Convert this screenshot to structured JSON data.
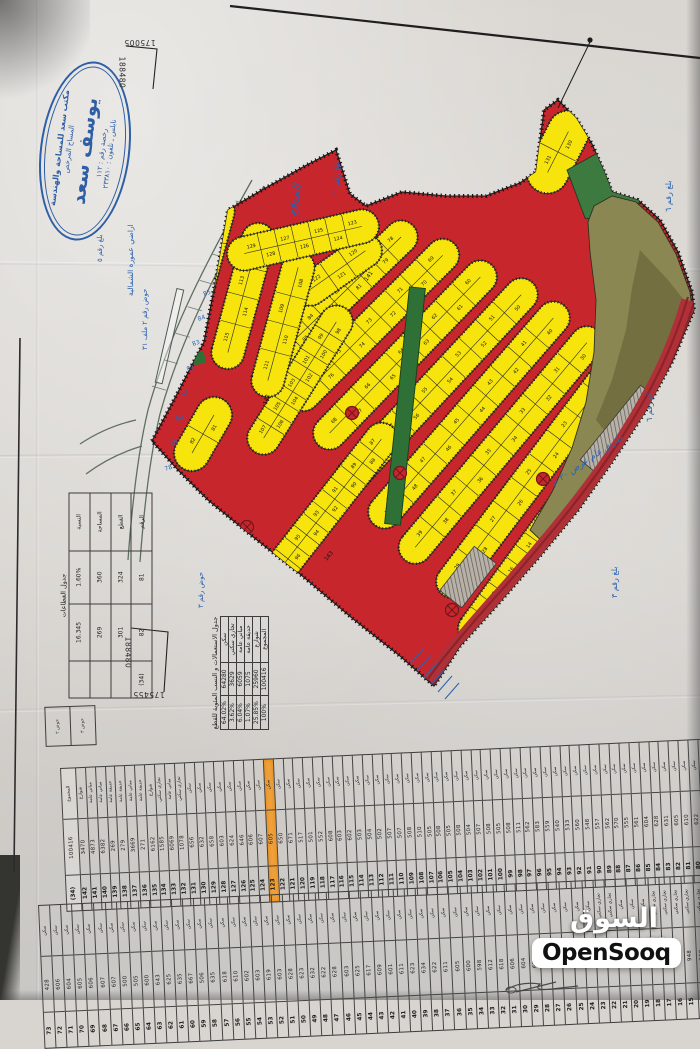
{
  "watermark": {
    "arabic": "السوق المفتوح",
    "latin": "OpenSooq"
  },
  "stamp": {
    "office": "مكتب سعد للمساحة والهندسة",
    "role": "المساح المرخص",
    "name": "يوسف سعد",
    "license": "رخصة رقم : ١١٢",
    "city_phone": "نابلس ـ تلفون : ٢٣٣٨١٠"
  },
  "grid_coords": {
    "top_x": "175005",
    "top_y": "188480",
    "bottom_x": "175455",
    "bottom_y": "188480"
  },
  "annotations": {
    "site_label": "الموقع",
    "area_line1": "اراضي عمورة الشمالية",
    "area_line2": "حوض رقم ٢ ملف ٣١",
    "basin_label": "حوض رقم ٣",
    "block2": "بلغ رقم ٢",
    "block3": "بلغ رقم ٣",
    "block5": "بلغ رقم ٥",
    "block6a": "بلغ رقم ٦",
    "block6b": "بلغ رقم ٦",
    "road_note": "طريق عام عرض ٢٠ م",
    "street_numbers": [
      "141",
      "142",
      "143"
    ],
    "edge_numbers": [
      "85",
      "84",
      "83",
      "82",
      "81",
      "80",
      "79",
      "78"
    ]
  },
  "use_table": {
    "title": "جدول الاستعمالات و النسب المئوية للقطع",
    "headers": [
      "الاستعمال",
      "المساحة م٢",
      "النسبة المئوية"
    ],
    "rows": [
      [
        "سكن",
        "64280",
        "64.02%"
      ],
      [
        "تجاري سكني",
        "3629",
        "3.62%"
      ],
      [
        "مباني عامة",
        "6059",
        "6.04%"
      ],
      [
        "حديقة عامة",
        "1075",
        "1.07%"
      ],
      [
        "شوارع",
        "25960",
        "25.85%"
      ],
      [
        "المجموع",
        "100416",
        "100%"
      ]
    ]
  },
  "sector_table": {
    "title": "جدول القطاعات",
    "rows": [
      [
        "النسبة",
        "1.60%",
        "16.345",
        ""
      ],
      [
        "المساحة",
        "360",
        "269",
        ""
      ],
      [
        "القطع",
        "324",
        "301",
        ""
      ],
      [
        "الرقم",
        "81",
        "82",
        "(34)"
      ]
    ]
  },
  "parcel_table": {
    "headers": {
      "use": "الاستعمال",
      "area": "المساحة م٢",
      "no": "رقم القطعة"
    },
    "highlight_no": "123",
    "default_use": "سكن",
    "strip1": [
      [
        "(34)",
        "100416",
        "المجموع"
      ],
      [
        "142",
        "3470",
        "شوارع"
      ],
      [
        "141",
        "4873",
        "مباني عامة"
      ],
      [
        "140",
        "6382",
        "مباني عامة"
      ],
      [
        "139",
        "269",
        "حديقة عامة"
      ],
      [
        "138",
        "279",
        "حديقة عامة"
      ],
      [
        "137",
        "3669",
        "مباني عامة"
      ],
      [
        "136",
        "271",
        "حديقة عامة"
      ],
      [
        "135",
        "6162",
        "شوارع"
      ],
      [
        "134",
        "1585",
        "تجاري سكني"
      ],
      [
        "133",
        "6069",
        "مباني عامة"
      ],
      [
        "132",
        "1078",
        "تجاري سكني"
      ],
      [
        "131",
        "656"
      ],
      [
        "130",
        "632"
      ],
      [
        "129",
        "658"
      ],
      [
        "128",
        "603"
      ],
      [
        "127",
        "624"
      ],
      [
        "126",
        "646"
      ],
      [
        "125",
        "606"
      ],
      [
        "124",
        "607"
      ],
      [
        "123",
        "605"
      ],
      [
        "122",
        "650"
      ],
      [
        "121",
        "671"
      ],
      [
        "120",
        "517"
      ],
      [
        "119",
        "501"
      ],
      [
        "118",
        "552"
      ],
      [
        "117",
        "608"
      ],
      [
        "116",
        "603"
      ],
      [
        "115",
        "602"
      ],
      [
        "114",
        "503"
      ],
      [
        "113",
        "504"
      ],
      [
        "112",
        "502"
      ],
      [
        "111",
        "507"
      ],
      [
        "110",
        "507"
      ],
      [
        "109",
        "508"
      ],
      [
        "108",
        "510"
      ],
      [
        "107",
        "505"
      ],
      [
        "106",
        "508"
      ],
      [
        "105",
        "505"
      ],
      [
        "104",
        "508"
      ],
      [
        "103",
        "504"
      ],
      [
        "102",
        "507"
      ],
      [
        "101",
        "508"
      ],
      [
        "100",
        "505"
      ],
      [
        "99",
        "508"
      ],
      [
        "98",
        "511"
      ],
      [
        "97",
        "562"
      ],
      [
        "96",
        "583"
      ],
      [
        "95",
        "559"
      ],
      [
        "94",
        "540"
      ],
      [
        "93",
        "533"
      ],
      [
        "92",
        "560"
      ],
      [
        "91",
        "548"
      ],
      [
        "90",
        "557"
      ],
      [
        "89",
        "562"
      ],
      [
        "88",
        "570"
      ],
      [
        "87",
        "555"
      ],
      [
        "86",
        "561"
      ],
      [
        "85",
        "604"
      ],
      [
        "84",
        "628"
      ],
      [
        "83",
        "631"
      ],
      [
        "82",
        "605"
      ],
      [
        "81",
        "610"
      ],
      [
        "80",
        "622"
      ],
      [
        "79",
        "618"
      ],
      [
        "78",
        "607"
      ],
      [
        "77",
        "606"
      ],
      [
        "76",
        "605"
      ],
      [
        "75",
        "604"
      ],
      [
        "74",
        "603"
      ]
    ],
    "strip2": [
      [
        "73",
        "428"
      ],
      [
        "72",
        "606"
      ],
      [
        "71",
        "604"
      ],
      [
        "70",
        "605"
      ],
      [
        "69",
        "606"
      ],
      [
        "68",
        "607"
      ],
      [
        "67",
        "607"
      ],
      [
        "66",
        "500"
      ],
      [
        "65",
        "505"
      ],
      [
        "64",
        "600"
      ],
      [
        "63",
        "643"
      ],
      [
        "62",
        "625"
      ],
      [
        "61",
        "635"
      ],
      [
        "60",
        "667"
      ],
      [
        "59",
        "506"
      ],
      [
        "58",
        "635"
      ],
      [
        "57",
        "618"
      ],
      [
        "56",
        "610"
      ],
      [
        "55",
        "602"
      ],
      [
        "54",
        "603"
      ],
      [
        "53",
        "619"
      ],
      [
        "52",
        "603"
      ],
      [
        "51",
        "628"
      ],
      [
        "50",
        "623"
      ],
      [
        "49",
        "632"
      ],
      [
        "48",
        "622"
      ],
      [
        "47",
        "628"
      ],
      [
        "46",
        "603"
      ],
      [
        "45",
        "625"
      ],
      [
        "44",
        "617"
      ],
      [
        "43",
        "609"
      ],
      [
        "42",
        "601"
      ],
      [
        "41",
        "611"
      ],
      [
        "40",
        "623"
      ],
      [
        "39",
        "634"
      ],
      [
        "38",
        "622"
      ],
      [
        "37",
        "611"
      ],
      [
        "36",
        "605"
      ],
      [
        "35",
        "600"
      ],
      [
        "34",
        "598"
      ],
      [
        "33",
        "612"
      ],
      [
        "32",
        "618"
      ],
      [
        "31",
        "606"
      ],
      [
        "30",
        "604"
      ],
      [
        "29",
        "611"
      ],
      [
        "28",
        "607"
      ],
      [
        "27",
        "610"
      ],
      [
        "26",
        "604"
      ],
      [
        "25",
        "606"
      ],
      [
        "24",
        "609"
      ],
      [
        "23",
        "1044",
        "تجاري سكني"
      ],
      [
        "22",
        "1008",
        "تجاري سكني"
      ],
      [
        "21",
        "640"
      ],
      [
        "20",
        "585"
      ],
      [
        "19",
        "560"
      ],
      [
        "18",
        "902",
        "تجاري سكني"
      ],
      [
        "17",
        "950",
        "تجاري سكني"
      ],
      [
        "16",
        "955",
        "تجاري سكني"
      ],
      [
        "15",
        "948",
        "تجاري سكني"
      ],
      [
        "14",
        "960",
        "تجاري سكني"
      ],
      [
        "13",
        "942",
        "تجاري سكني"
      ],
      [
        "12",
        "938",
        "تجاري سكني"
      ]
    ]
  },
  "map": {
    "bands": [
      {
        "lots": [
          20,
          19,
          18,
          17,
          16,
          15,
          14,
          13,
          12,
          11,
          10,
          9,
          8,
          7,
          6,
          5,
          4,
          3,
          2,
          1
        ]
      },
      {
        "lots": [
          29,
          28,
          27,
          26,
          25,
          24,
          23,
          22,
          21
        ]
      },
      {
        "lots": [
          39,
          38,
          37,
          36,
          35,
          34,
          33,
          32,
          31,
          30
        ]
      },
      {
        "lots": [
          49,
          48,
          47,
          46,
          45,
          44,
          43,
          42,
          41,
          40
        ]
      },
      {
        "lots": [
          59,
          58,
          57,
          56,
          55,
          54,
          53,
          52,
          51,
          50
        ]
      },
      {
        "lots": [
          68,
          67,
          66,
          65,
          64,
          63,
          62,
          61,
          60
        ]
      },
      {
        "lots": [
          77,
          76,
          75,
          74,
          73,
          72,
          71,
          70,
          69
        ]
      },
      {
        "lots": [
          86,
          85,
          84,
          83,
          82,
          81,
          80,
          79,
          78
        ]
      },
      {
        "lots": [
          97,
          96,
          95,
          94,
          93,
          92,
          91,
          90,
          89,
          88,
          87
        ]
      },
      {
        "lots": [
          107,
          106,
          105,
          104,
          103,
          102,
          101,
          100,
          99,
          98
        ]
      },
      {
        "lots": [
          122,
          121,
          120
        ]
      },
      {
        "lots": [
          119,
          118,
          117,
          116
        ]
      },
      {
        "lots": [
          115,
          114,
          113,
          112
        ]
      },
      {
        "lots": [
          111,
          110,
          109,
          108
        ]
      },
      {
        "lots": [
          82,
          81
        ]
      },
      {
        "lots": [
          129,
          128,
          127,
          126,
          125,
          124,
          123
        ]
      },
      {
        "lots": [
          131,
          130
        ]
      }
    ],
    "colors": {
      "lot_yellow": "#f6e40c",
      "road_red": "#c7262d",
      "park_green": "#2f7036",
      "wild_olive": "#8a8752",
      "hatch_gray": "#b7b1a8",
      "annotation_blue": "#2b62b0",
      "stamp_blue": "#2d5ea6",
      "highlight_orange": "#efa13b"
    }
  }
}
